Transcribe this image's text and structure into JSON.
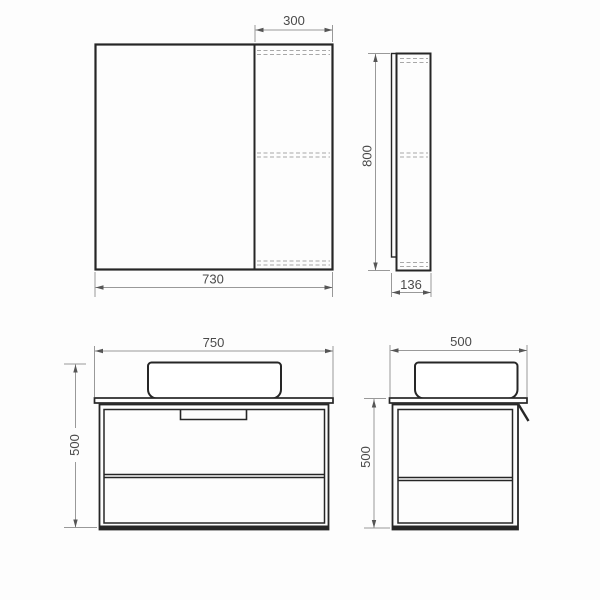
{
  "title": "Bathroom furniture dimensional drawing",
  "colors": {
    "background": "#fdfdfd",
    "object_line": "#262626",
    "dimension_line": "#999999",
    "hidden_line": "#a8a8a8",
    "arrow": "#555555",
    "text": "#4a4a4a"
  },
  "views": {
    "mirror_front": {
      "door_width": "300",
      "total_width": "730"
    },
    "mirror_side": {
      "height": "800",
      "depth": "136"
    },
    "vanity_front": {
      "width": "750",
      "height": "500"
    },
    "vanity_side": {
      "width": "500",
      "height": "500"
    }
  }
}
